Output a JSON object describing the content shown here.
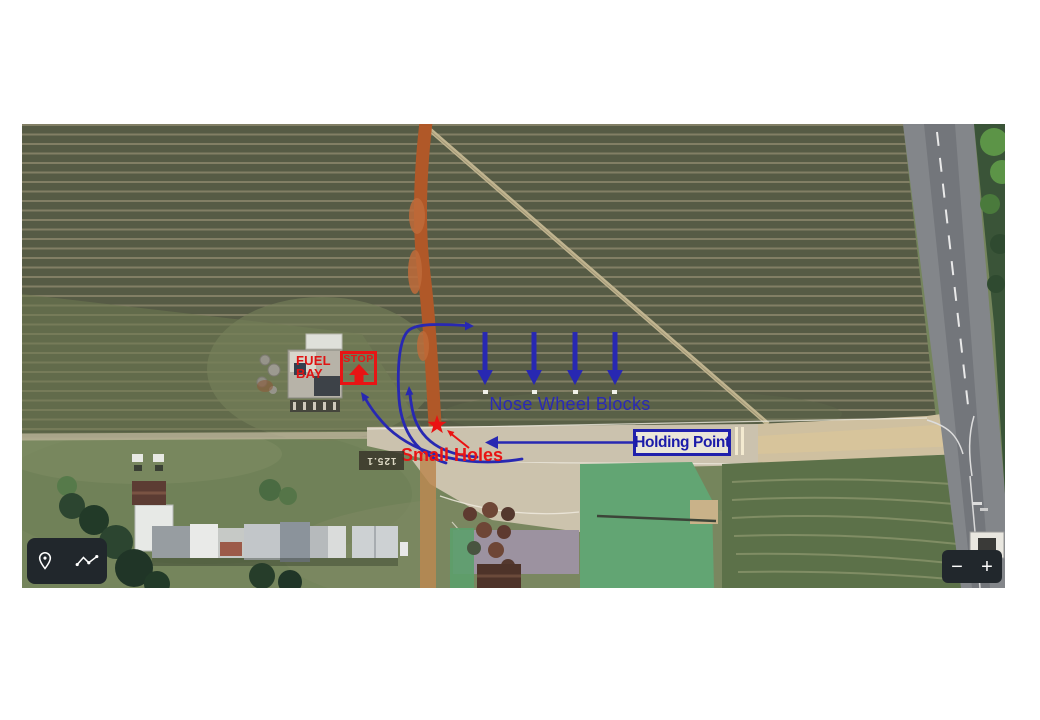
{
  "map": {
    "view": "aerial-satellite",
    "annotations": {
      "fuel_bay": {
        "line1": "FUEL",
        "line2": "BAY",
        "color": "#e01212"
      },
      "stop_box": {
        "label": "STOP",
        "color": "#e81414"
      },
      "nose_wheel_blocks": {
        "label": "Nose Wheel Blocks",
        "color": "#2a2ab5",
        "arrow_count": 4
      },
      "holding_point": {
        "label": "Holding Point",
        "color": "#1b1baa"
      },
      "small_holes": {
        "label": "Small Holes",
        "color": "#e81414"
      }
    },
    "ground_marking": {
      "frequency": "125.1"
    },
    "colors": {
      "annotation_red": "#e81414",
      "annotation_blue": "#2828b2",
      "grass": "#75855c",
      "crop_field": "#565b45",
      "dirt_track": "#b05828",
      "taxiway": "#ccc3ae",
      "road": "#84878b",
      "control_background": "#21272c"
    }
  },
  "controls": {
    "annotation_toolbar": {
      "icons": [
        "location-pin-icon",
        "route-polyline-icon"
      ]
    },
    "zoom_control": {
      "zoom_out_label": "−",
      "zoom_in_label": "+"
    }
  }
}
